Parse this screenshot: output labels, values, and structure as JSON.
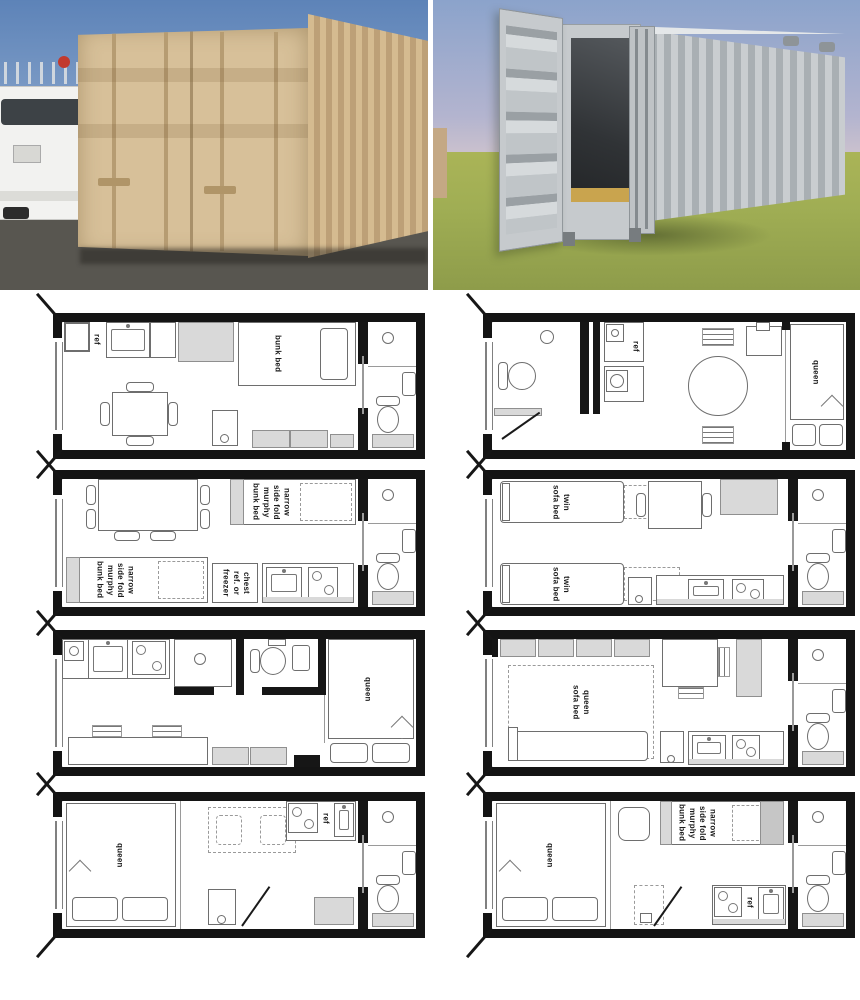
{
  "palette": {
    "plan_wall": "#141414",
    "fixture_gray": "#d9d9d9",
    "left_photo_sky": "#6d8fbd",
    "left_photo_container_tan": "#d7c199",
    "left_photo_asphalt": "#56544f",
    "right_photo_sky": "#93a9cf",
    "right_photo_grass": "#a4b05a",
    "right_photo_container_gray": "#bcc0c3"
  },
  "plans": [
    {
      "name": "plan-1",
      "labels": {
        "ref": "ref",
        "bunk_bed": "bunk bed"
      }
    },
    {
      "name": "plan-2",
      "labels": {
        "ref": "ref",
        "queen": "queen"
      }
    },
    {
      "name": "plan-3",
      "labels": {
        "murphy_top": "narrow\nside fold\nmurphy\nbunk bed",
        "chest": "chest\nref. or\nfreezer",
        "murphy_bottom": "narrow\nside fold\nmurphy\nbunk bed"
      }
    },
    {
      "name": "plan-4",
      "labels": {
        "twin_top": "twin\nsofa bed",
        "twin_bottom": "twin\nsofa bed"
      }
    },
    {
      "name": "plan-5",
      "labels": {
        "queen": "queen"
      }
    },
    {
      "name": "plan-6",
      "labels": {
        "queen_sofa": "queen\nsofa bed"
      }
    },
    {
      "name": "plan-7",
      "labels": {
        "queen": "queen",
        "ref": "ref"
      }
    },
    {
      "name": "plan-8",
      "labels": {
        "queen": "queen",
        "murphy": "narrow\nside fold\nmurphy\nbunk bed",
        "ref": "ref"
      }
    }
  ]
}
